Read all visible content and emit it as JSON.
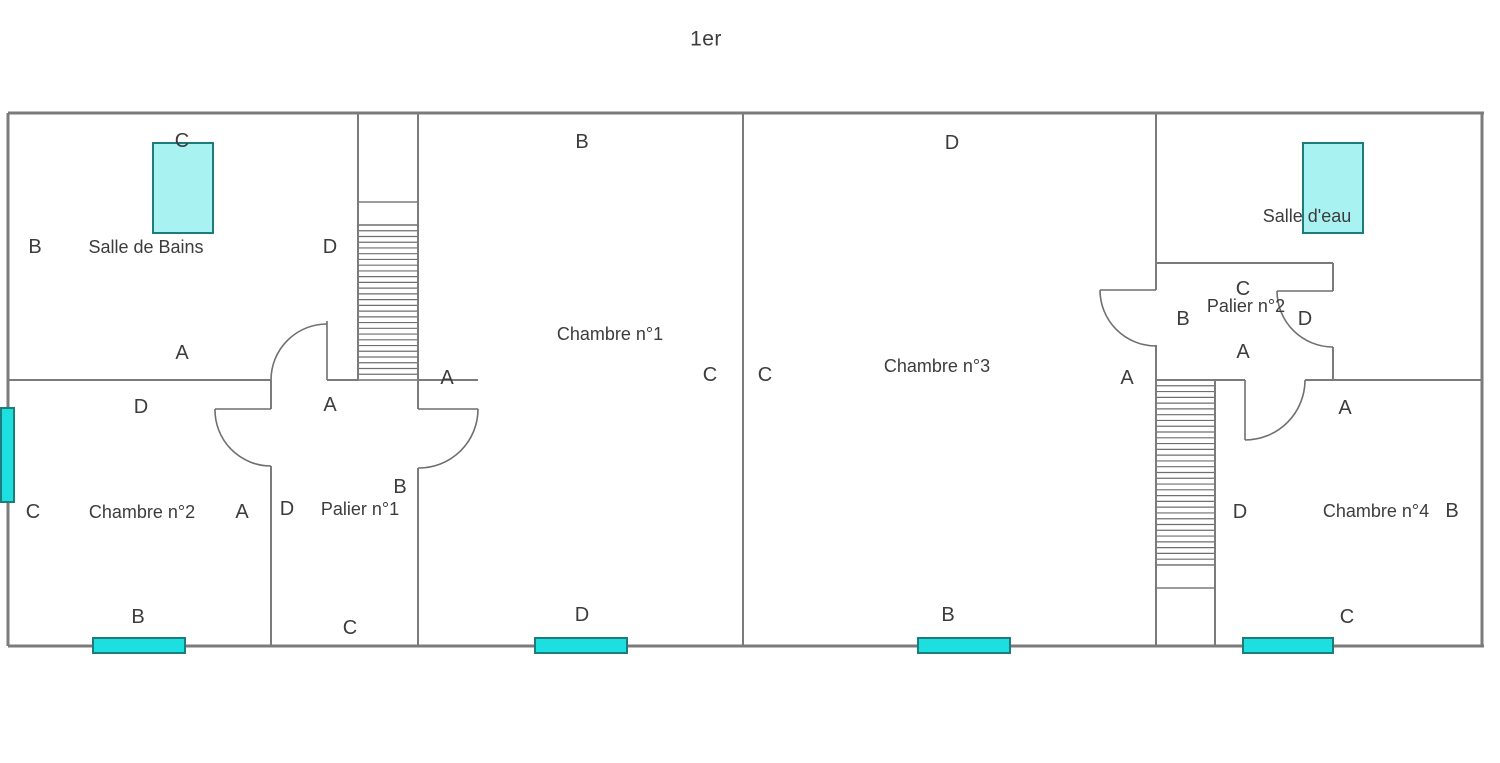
{
  "title": "1er",
  "colors": {
    "background": "#ffffff",
    "wall": "#7b7b7b",
    "thin_line": "#6f6f6f",
    "text": "#3c3c3c",
    "window_bright_fill": "#1edfe0",
    "window_light_fill": "#a9f2f2",
    "window_border": "#1d7d7d"
  },
  "canvas": {
    "width": 1500,
    "height": 763
  },
  "plan": {
    "rooms": [
      {
        "label": "Salle de Bains",
        "x": 146,
        "y": 247
      },
      {
        "label": "Chambre n°1",
        "x": 610,
        "y": 334
      },
      {
        "label": "Chambre n°2",
        "x": 142,
        "y": 512
      },
      {
        "label": "Palier n°1",
        "x": 360,
        "y": 509
      },
      {
        "label": "Chambre n°3",
        "x": 937,
        "y": 366
      },
      {
        "label": "Palier n°2",
        "x": 1246,
        "y": 306
      },
      {
        "label": "Salle d'eau",
        "x": 1307,
        "y": 216
      },
      {
        "label": "Chambre n°4",
        "x": 1376,
        "y": 511
      }
    ],
    "letters": [
      {
        "t": "B",
        "x": 582,
        "y": 142
      },
      {
        "t": "D",
        "x": 952,
        "y": 143
      },
      {
        "t": "C",
        "x": 182,
        "y": 141
      },
      {
        "t": "B",
        "x": 35,
        "y": 247
      },
      {
        "t": "D",
        "x": 330,
        "y": 247
      },
      {
        "t": "A",
        "x": 182,
        "y": 353
      },
      {
        "t": "A",
        "x": 330,
        "y": 405
      },
      {
        "t": "A",
        "x": 447,
        "y": 378
      },
      {
        "t": "B",
        "x": 400,
        "y": 487
      },
      {
        "t": "D",
        "x": 141,
        "y": 407
      },
      {
        "t": "C",
        "x": 33,
        "y": 512
      },
      {
        "t": "A",
        "x": 242,
        "y": 512
      },
      {
        "t": "D",
        "x": 287,
        "y": 509
      },
      {
        "t": "C",
        "x": 710,
        "y": 375
      },
      {
        "t": "C",
        "x": 765,
        "y": 375
      },
      {
        "t": "A",
        "x": 1127,
        "y": 378
      },
      {
        "t": "C",
        "x": 1243,
        "y": 289
      },
      {
        "t": "B",
        "x": 1183,
        "y": 319
      },
      {
        "t": "D",
        "x": 1305,
        "y": 319
      },
      {
        "t": "A",
        "x": 1243,
        "y": 352
      },
      {
        "t": "A",
        "x": 1345,
        "y": 408
      },
      {
        "t": "D",
        "x": 1240,
        "y": 512
      },
      {
        "t": "B",
        "x": 1452,
        "y": 511
      },
      {
        "t": "B",
        "x": 138,
        "y": 617
      },
      {
        "t": "C",
        "x": 350,
        "y": 628
      },
      {
        "t": "D",
        "x": 582,
        "y": 615
      },
      {
        "t": "B",
        "x": 948,
        "y": 615
      },
      {
        "t": "C",
        "x": 1347,
        "y": 617
      }
    ],
    "walls": [
      {
        "x1": 8,
        "y1": 113,
        "x2": 1484,
        "y2": 113,
        "w": 3
      },
      {
        "x1": 8,
        "y1": 646,
        "x2": 1484,
        "y2": 646,
        "w": 3
      },
      {
        "x1": 8,
        "y1": 113,
        "x2": 8,
        "y2": 646,
        "w": 3
      },
      {
        "x1": 1482,
        "y1": 113,
        "x2": 1482,
        "y2": 646,
        "w": 3
      },
      {
        "x1": 743,
        "y1": 113,
        "x2": 743,
        "y2": 646,
        "w": 2
      },
      {
        "x1": 358,
        "y1": 113,
        "x2": 358,
        "y2": 380,
        "w": 2
      },
      {
        "x1": 418,
        "y1": 113,
        "x2": 418,
        "y2": 409,
        "w": 2
      },
      {
        "x1": 8,
        "y1": 380,
        "x2": 271,
        "y2": 380,
        "w": 2
      },
      {
        "x1": 327,
        "y1": 380,
        "x2": 358,
        "y2": 380,
        "w": 2
      },
      {
        "x1": 358,
        "y1": 380,
        "x2": 418,
        "y2": 380,
        "w": 1.4
      },
      {
        "x1": 418,
        "y1": 380,
        "x2": 478,
        "y2": 380,
        "w": 2
      },
      {
        "x1": 271,
        "y1": 380,
        "x2": 271,
        "y2": 409,
        "w": 2
      },
      {
        "x1": 271,
        "y1": 466,
        "x2": 271,
        "y2": 646,
        "w": 2
      },
      {
        "x1": 418,
        "y1": 468,
        "x2": 418,
        "y2": 646,
        "w": 2
      },
      {
        "x1": 358,
        "y1": 202,
        "x2": 418,
        "y2": 202,
        "w": 1.4
      },
      {
        "x1": 358,
        "y1": 225,
        "x2": 418,
        "y2": 225,
        "w": 1.4
      },
      {
        "x1": 1156,
        "y1": 113,
        "x2": 1156,
        "y2": 290,
        "w": 2
      },
      {
        "x1": 1156,
        "y1": 345,
        "x2": 1156,
        "y2": 380,
        "w": 2
      },
      {
        "x1": 1156,
        "y1": 263,
        "x2": 1333,
        "y2": 263,
        "w": 2
      },
      {
        "x1": 1333,
        "y1": 263,
        "x2": 1333,
        "y2": 291,
        "w": 2
      },
      {
        "x1": 1333,
        "y1": 347,
        "x2": 1333,
        "y2": 380,
        "w": 2
      },
      {
        "x1": 1156,
        "y1": 380,
        "x2": 1245,
        "y2": 380,
        "w": 2
      },
      {
        "x1": 1305,
        "y1": 380,
        "x2": 1482,
        "y2": 380,
        "w": 2
      },
      {
        "x1": 1156,
        "y1": 380,
        "x2": 1156,
        "y2": 646,
        "w": 2
      },
      {
        "x1": 1215,
        "y1": 380,
        "x2": 1215,
        "y2": 646,
        "w": 2
      },
      {
        "x1": 1156,
        "y1": 565,
        "x2": 1215,
        "y2": 565,
        "w": 1.4
      },
      {
        "x1": 1156,
        "y1": 588,
        "x2": 1215,
        "y2": 588,
        "w": 1.4
      }
    ],
    "doors": [
      {
        "leaf": [
          327,
          321,
          327,
          380
        ],
        "arc_start": [
          271,
          380
        ],
        "arc_end": [
          327,
          324
        ],
        "r": 56,
        "sweep": 1
      },
      {
        "leaf": [
          215,
          409,
          271,
          409
        ],
        "arc_start": [
          215,
          409
        ],
        "arc_end": [
          271,
          466
        ],
        "r": 56,
        "sweep": 0
      },
      {
        "leaf": [
          418,
          409,
          478,
          409
        ],
        "arc_start": [
          478,
          409
        ],
        "arc_end": [
          418,
          468
        ],
        "r": 59,
        "sweep": 1
      },
      {
        "leaf": [
          1100,
          290,
          1156,
          290
        ],
        "arc_start": [
          1100,
          290
        ],
        "arc_end": [
          1156,
          346
        ],
        "r": 56,
        "sweep": 0
      },
      {
        "leaf": [
          1277,
          291,
          1333,
          291
        ],
        "arc_start": [
          1277,
          291
        ],
        "arc_end": [
          1333,
          347
        ],
        "r": 56,
        "sweep": 0
      },
      {
        "leaf": [
          1245,
          380,
          1245,
          440
        ],
        "arc_start": [
          1245,
          440
        ],
        "arc_end": [
          1305,
          380
        ],
        "r": 60,
        "sweep": 0
      }
    ],
    "stairs": [
      {
        "x1": 358,
        "x2": 418,
        "from": 225,
        "to": 380,
        "step": 5.74
      },
      {
        "x1": 1156,
        "x2": 1215,
        "from": 380,
        "to": 565,
        "step": 5.78
      }
    ],
    "windows": [
      {
        "x": 153,
        "y": 143,
        "w": 60,
        "h": 90,
        "fill": "light"
      },
      {
        "x": 1303,
        "y": 143,
        "w": 60,
        "h": 90,
        "fill": "light"
      },
      {
        "x": 1,
        "y": 408,
        "w": 13,
        "h": 94,
        "fill": "bright"
      },
      {
        "x": 93,
        "y": 638,
        "w": 92,
        "h": 15,
        "fill": "bright"
      },
      {
        "x": 535,
        "y": 638,
        "w": 92,
        "h": 15,
        "fill": "bright"
      },
      {
        "x": 918,
        "y": 638,
        "w": 92,
        "h": 15,
        "fill": "bright"
      },
      {
        "x": 1243,
        "y": 638,
        "w": 90,
        "h": 15,
        "fill": "bright"
      }
    ]
  }
}
